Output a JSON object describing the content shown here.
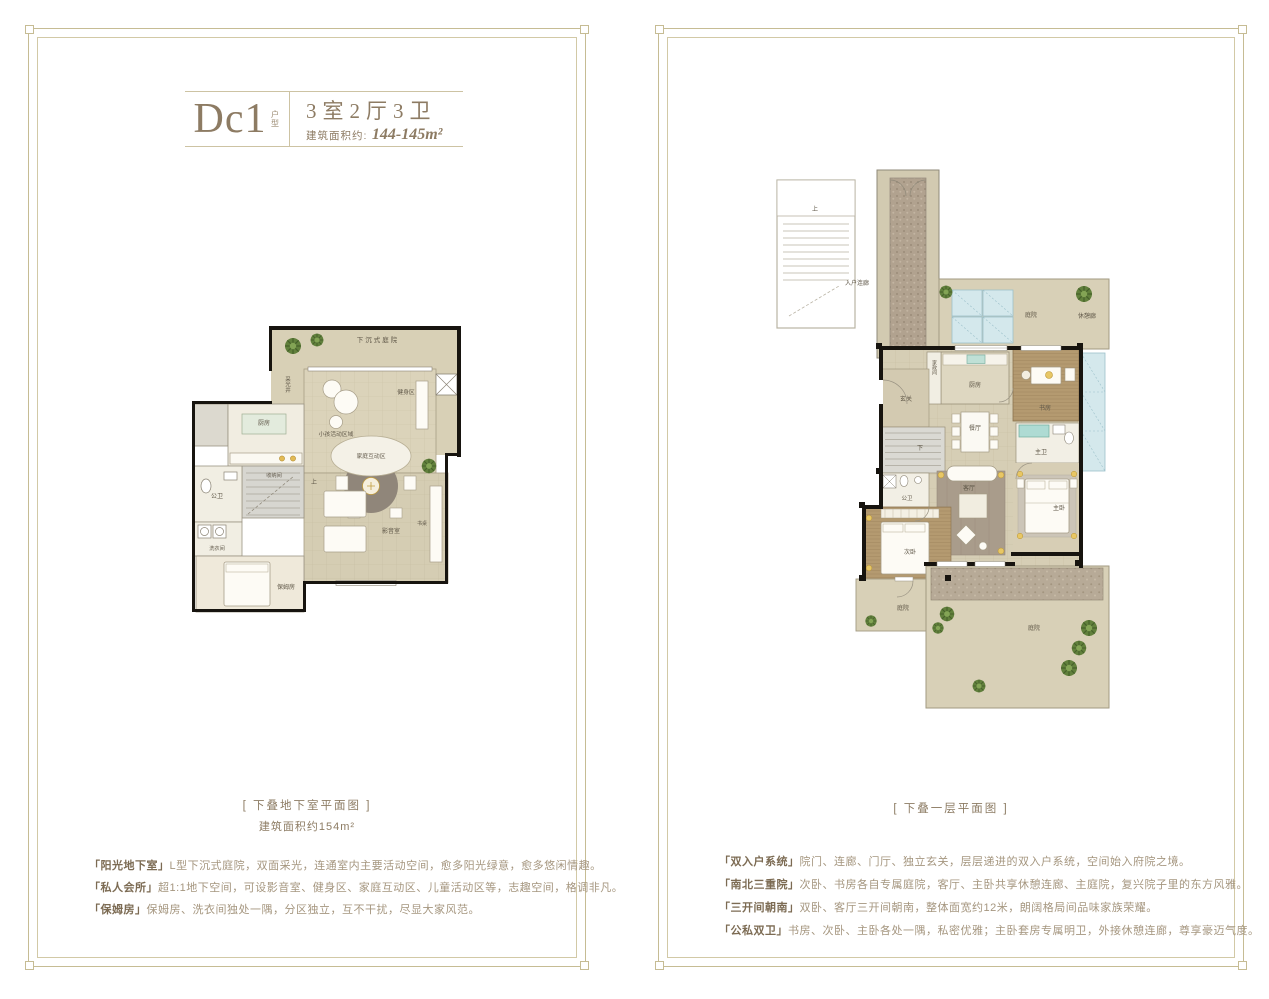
{
  "left_panel": {
    "title": {
      "code": "Dc1",
      "code_suffix": "户型",
      "rooms_spec": "3室2厅3卫",
      "area_label": "建筑面积约:",
      "area_value": "144-145m²"
    },
    "caption": "[ 下叠地下室平面图 ]",
    "caption_sub": "建筑面积约154m²",
    "features": [
      {
        "term": "「阳光地下室」",
        "desc": "L型下沉式庭院，双面采光，连通室内主要活动空间，愈多阳光绿意，愈多悠闲情趣。"
      },
      {
        "term": "「私人会所」",
        "desc": "超1:1地下空间，可设影音室、健身区、家庭互动区、儿童活动区等，志趣空间，格调非凡。"
      },
      {
        "term": "「保姆房」",
        "desc": "保姆房、洗衣间独处一隅，分区独立，互不干扰，尽显大家风范。"
      }
    ],
    "plan_rooms": {
      "sunken_courtyard": "下沉式庭院",
      "light_well": "采光井",
      "kids_area": "小孩活动区域",
      "gym": "健身区",
      "family_zone": "家庭互动区",
      "kitchen": "厨房",
      "storage": "收纳间",
      "bath": "公卫",
      "laundry": "洗衣间",
      "nanny": "保姆房",
      "media": "影音室",
      "desk": "书桌",
      "up": "上"
    }
  },
  "right_panel": {
    "caption": "[ 下叠一层平面图 ]",
    "features": [
      {
        "term": "「双入户系统」",
        "desc": "院门、连廊、门厅、独立玄关，层层递进的双入户系统，空间始入府院之境。"
      },
      {
        "term": "「南北三重院」",
        "desc": "次卧、书房各自专属庭院，客厅、主卧共享休憩连廊、主庭院，复兴院子里的东方风雅。"
      },
      {
        "term": "「三开间朝南」",
        "desc": "双卧、客厅三开间朝南，整体面宽约12米，朗阔格局间品味家族荣耀。"
      },
      {
        "term": "「公私双卫」",
        "desc": "书房、次卧、主卧各处一隅，私密优雅；主卧套房专属明卫，外接休憩连廊，尊享豪迈气度。"
      }
    ],
    "plan_rooms": {
      "entry_corridor": "入户连廊",
      "courtyard_top": "庭院",
      "rest_corridor": "休憩廊",
      "kitchen": "厨房",
      "housework": "家政间",
      "study": "书房",
      "foyer": "玄关",
      "dining": "餐厅",
      "master_bath": "主卫",
      "living": "客厅",
      "master_bed": "主卧",
      "bath": "公卫",
      "second_bed": "次卧",
      "courtyard_side": "庭院",
      "courtyard_main": "庭院",
      "up": "上",
      "down": "下"
    }
  }
}
